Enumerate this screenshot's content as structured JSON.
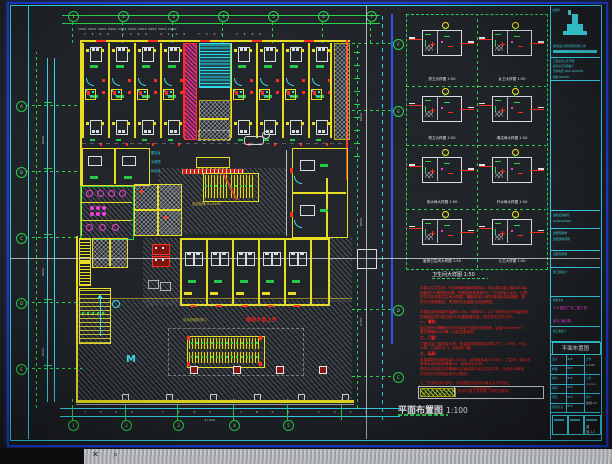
{
  "colors": {
    "border_blue": "#1d3fd8",
    "border_cyan": "#35d8f2",
    "axis_green": "#2ad24b",
    "wall_yellow": "#e8dd20",
    "alert_red": "#ff2d1f",
    "magenta": "#f23cdb",
    "cyan": "#2ee2f0",
    "note_red": "#ff2115",
    "text_white": "#dfe5e9"
  },
  "plan": {
    "caption_title": "平面布置图",
    "caption_scale": "1:100",
    "void_label_red": "酒店大堂上空",
    "void_label_yellow": "自动扶梯检修口",
    "escalator_label": "自动扶梯 H=5100",
    "stair_mark": "M",
    "lobby_tags": [
      "服务台",
      "大堂吧",
      "休息区"
    ]
  },
  "axes": {
    "top": [
      "1",
      "2",
      "3",
      "4",
      "5",
      "6",
      "7"
    ],
    "left": [
      "A",
      "B",
      "C",
      "D",
      "E"
    ],
    "bottom": [
      "1",
      "2",
      "3",
      "4",
      "5"
    ],
    "right": [
      "F",
      "E",
      "D",
      "C"
    ]
  },
  "dims": {
    "top_row1": "2900 3600 3600 3600 2050 2050 3600 3600 3600 2900",
    "top_row2": "7500 7300 4100 7300 7500",
    "left_col": [
      "8000",
      "9000",
      "8000"
    ],
    "right_col": [
      "8000",
      "8000",
      "5700"
    ],
    "bottom_row": "7500 7500 7800 7500",
    "bottom_total": "27400"
  },
  "details": {
    "caption_title": "卫生间大样图",
    "caption_scale": "1:50",
    "cells": [
      {
        "label": "男卫大样图",
        "scale": "1:50"
      },
      {
        "label": "女卫大样图",
        "scale": "1:50"
      },
      {
        "label": "残卫大样图",
        "scale": "1:50"
      },
      {
        "label": "清洁间大样图",
        "scale": "1:50"
      },
      {
        "label": "茶水间大样图",
        "scale": "1:50"
      },
      {
        "label": "开水间大样图",
        "scale": "1:50"
      },
      {
        "label": "客房卫生间大样图",
        "scale": "1:50"
      },
      {
        "label": "公卫大样图",
        "scale": "1:50"
      }
    ]
  },
  "notes": {
    "lines": [
      {
        "k": "b",
        "t": "本层公共卫生间、开水间墙地面均做防水，防水层沿墙上翻1800高，"
      },
      {
        "k": "b",
        "t": "地面找1%坡坡向地漏，完成面较走道低20，门口处做止水坎，洁具"
      },
      {
        "k": "b",
        "t": "定位详见本图卫生间大样图，隔断采用12厚抗倍特板成品隔断，配"
      },
      {
        "k": "b",
        "t": "件为不锈钢制品，吊顶材料及高度详见装修图。"
      },
      {
        "k": "g",
        "t": ""
      },
      {
        "k": "b",
        "t": "本层自动扶梯提升高度5.10m，倾角30°，由厂家深化设计预留预埋，"
      },
      {
        "k": "b",
        "t": "扶梯周边洞口临边设1100高玻璃栏板，做法详见栏杆大样。"
      },
      {
        "k": "h",
        "t": "一、墙体："
      },
      {
        "k": "b",
        "t": "除注明外内隔墙均为200厚加气混凝土砌块墙，容重≤6.5kN/m³，"
      },
      {
        "k": "b",
        "t": "管井隔墙为100厚，均砌至梁板底。"
      },
      {
        "k": "h",
        "t": "二、门窗："
      },
      {
        "k": "b",
        "t": "门窗详见门窗表及大样，安装前须现场核实洞口尺寸，FM甲、FM乙"
      },
      {
        "k": "b",
        "t": "为甲、乙级防火门，均装闭门器。"
      },
      {
        "k": "h",
        "t": "三、标高："
      },
      {
        "k": "b",
        "t": "本层建筑完成面标高5.100m，结构面标高5.050m，卫生间、清洁间"
      },
      {
        "k": "b",
        "t": "等有水房间结构降板50，找坡详见大样。"
      },
      {
        "k": "b",
        "t": "图中未注明定位的隔墙均沿轴线居中或与柱边平齐，其余未尽事宜"
      },
      {
        "k": "b",
        "t": "详见设计总说明及各专业图纸。"
      },
      {
        "k": "g",
        "t": ""
      },
      {
        "k": "b",
        "t": "凡二次深化设计部位，深化图纸须经设计确认后方可施工，"
      },
      {
        "k": "c",
        "t": "（详见总说明）"
      }
    ]
  },
  "legend": {
    "text": "表示中庭上空范围（本层无楼板）"
  },
  "title_block": {
    "page_tag": "出图章",
    "company": "建筑设计研究院有限公司",
    "info_lines": [
      "工程设计证书 甲级",
      "勘察设计注册编号",
      "咨询电话 0000-0000000",
      "邮编 000000"
    ],
    "cert_lines": [
      "资质证书编号",
      "A100000000"
    ],
    "seal_lines": [
      "出图专用章",
      "注册建筑师章"
    ],
    "project_lines": [
      "ＸＸ国际广场二期工程",
      "商业·酒店楼"
    ],
    "sub_lines": [
      "建筑专业",
      "施工图设计"
    ],
    "drawing_name": "平面布置图",
    "table_rows": [
      [
        "设计",
        "××"
      ],
      [
        "制图",
        "××"
      ],
      [
        "校对",
        "××"
      ],
      [
        "审核",
        "××"
      ],
      [
        "审定",
        "××"
      ],
      [
        "项目负责",
        "××"
      ]
    ],
    "meta_rows": [
      [
        "比例",
        "1:100"
      ],
      [
        "日期",
        "××××"
      ],
      [
        "图号",
        "建施-12"
      ]
    ]
  },
  "status_band": {
    "icons": [
      "✕",
      "⌕"
    ]
  }
}
